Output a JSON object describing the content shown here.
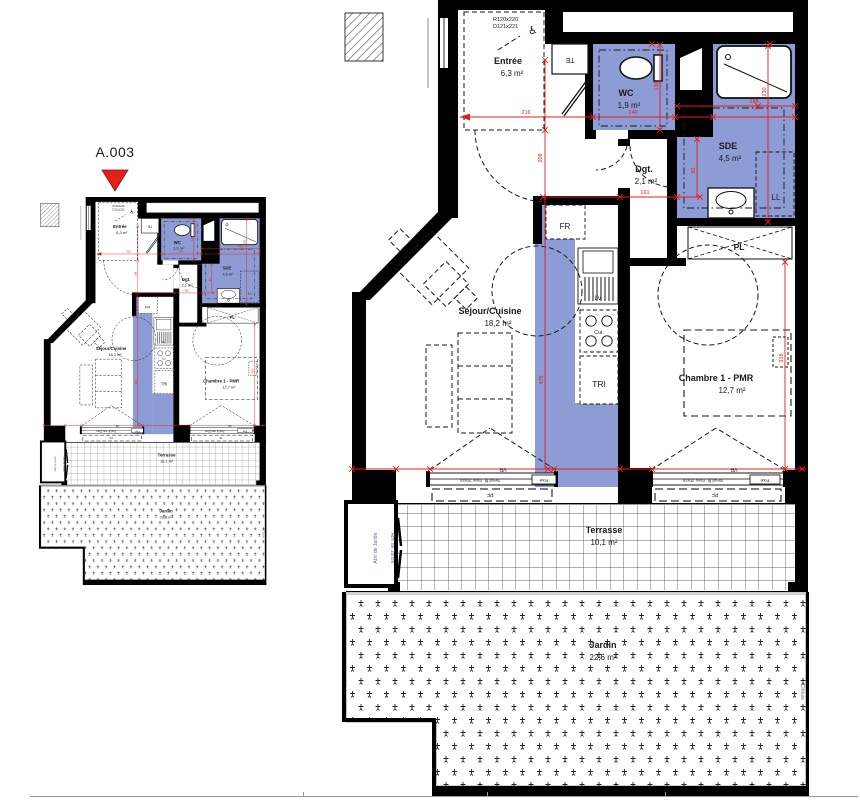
{
  "plan": {
    "unit_label": "A.003",
    "rooms": {
      "entree": {
        "name": "Entrée",
        "area": "6,3 m²"
      },
      "wc": {
        "name": "WC",
        "area": "1,9 m²"
      },
      "sde": {
        "name": "SDE",
        "area": "4,5 m²"
      },
      "dgt": {
        "name": "Dgt.",
        "area": "2,1 m²"
      },
      "sejour": {
        "name": "Séjour/Cuisine",
        "area": "18,2 m²"
      },
      "chambre": {
        "name": "Chambre 1 - PMR",
        "area": "12,7 m²"
      },
      "terrasse": {
        "name": "Terrasse",
        "area": "10,1 m²"
      },
      "jardin": {
        "name": "Jardin",
        "area": "22,6 m²"
      }
    },
    "fixtures": {
      "te": "TE",
      "fr": "FR",
      "lv": "LV",
      "cui": "Cui.",
      "tri": "TRI",
      "ll": "LL",
      "pl": "PL"
    },
    "door_note": {
      "line1": "R120x220",
      "line2": "D121x221"
    },
    "wheelchair_icon": "♿",
    "window_labels": {
      "vr": "VR",
      "seuil": "Seuil fil. max 20cm",
      "fixe": "Fixe",
      "pf": "PF"
    },
    "annotations": {
      "abri": "Abri de Jardin",
      "cloture": "Clôture"
    },
    "dimensions": {
      "d216": "216",
      "d140": "140",
      "d195": "195",
      "d161": "161",
      "d208": "208",
      "d476": "476",
      "d230": "230",
      "d318": "318",
      "d136": "136",
      "d81": "81"
    },
    "colors": {
      "wet_zone": "#8e9cd5",
      "dimension": "#e51c1c",
      "annotation": "#5a6b9e",
      "marker": "#e3201c"
    }
  }
}
